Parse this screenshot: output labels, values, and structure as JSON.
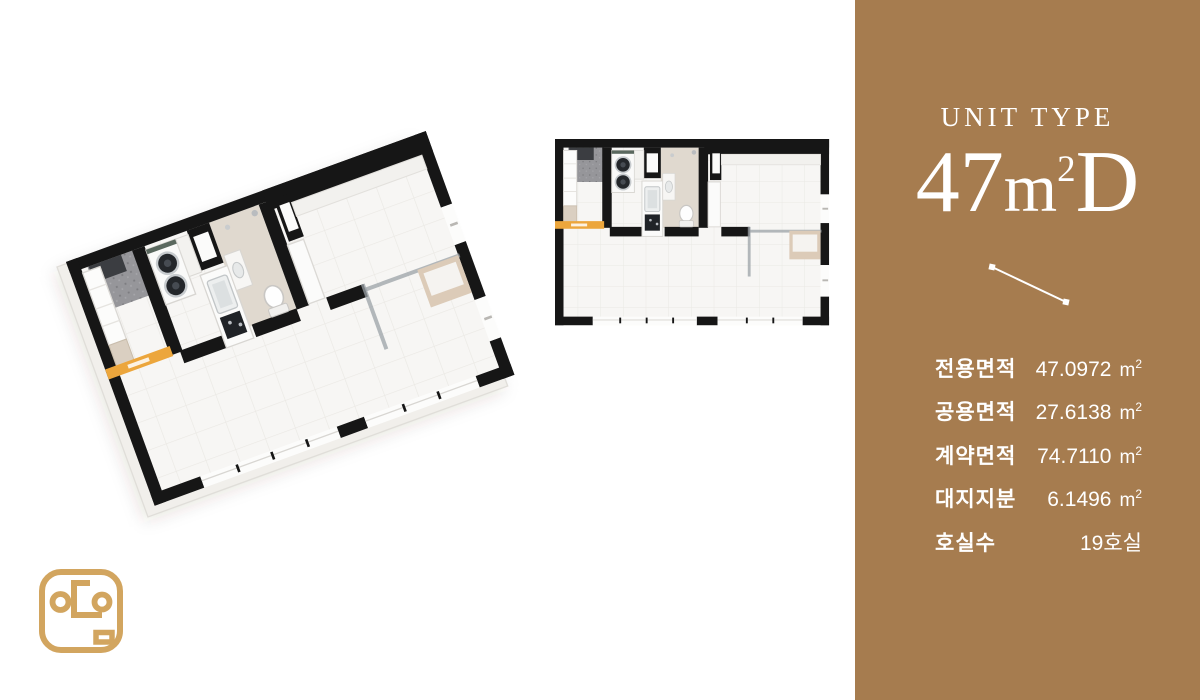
{
  "panel": {
    "bg_color": "#A67C4F",
    "text_color": "#FFFFFF",
    "eyebrow": "UNIT TYPE",
    "unit": {
      "num": "47",
      "meter": "m",
      "sup": "2",
      "suffix": "D"
    },
    "rows": [
      {
        "label": "전용면적",
        "value": "47.0972",
        "unit": "m",
        "unit_sup": "2"
      },
      {
        "label": "공용면적",
        "value": "27.6138",
        "unit": "m",
        "unit_sup": "2"
      },
      {
        "label": "계약면적",
        "value": "74.7110",
        "unit": "m",
        "unit_sup": "2"
      },
      {
        "label": "대지지분",
        "value": "6.1496",
        "unit": "m",
        "unit_sup": "2"
      },
      {
        "label": "호실수",
        "value": "19호실",
        "unit": "",
        "unit_sup": ""
      }
    ]
  },
  "floorplan": {
    "wall_color": "#161616",
    "floor_color": "#F7F6F4",
    "entry_tile_color": "#96969A",
    "bath_floor_color": "#E0D9CF",
    "entrance_strip_color": "#ECA63C",
    "views": [
      "3d-perspective",
      "top-down"
    ]
  },
  "logo": {
    "color": "#D2A55F"
  }
}
